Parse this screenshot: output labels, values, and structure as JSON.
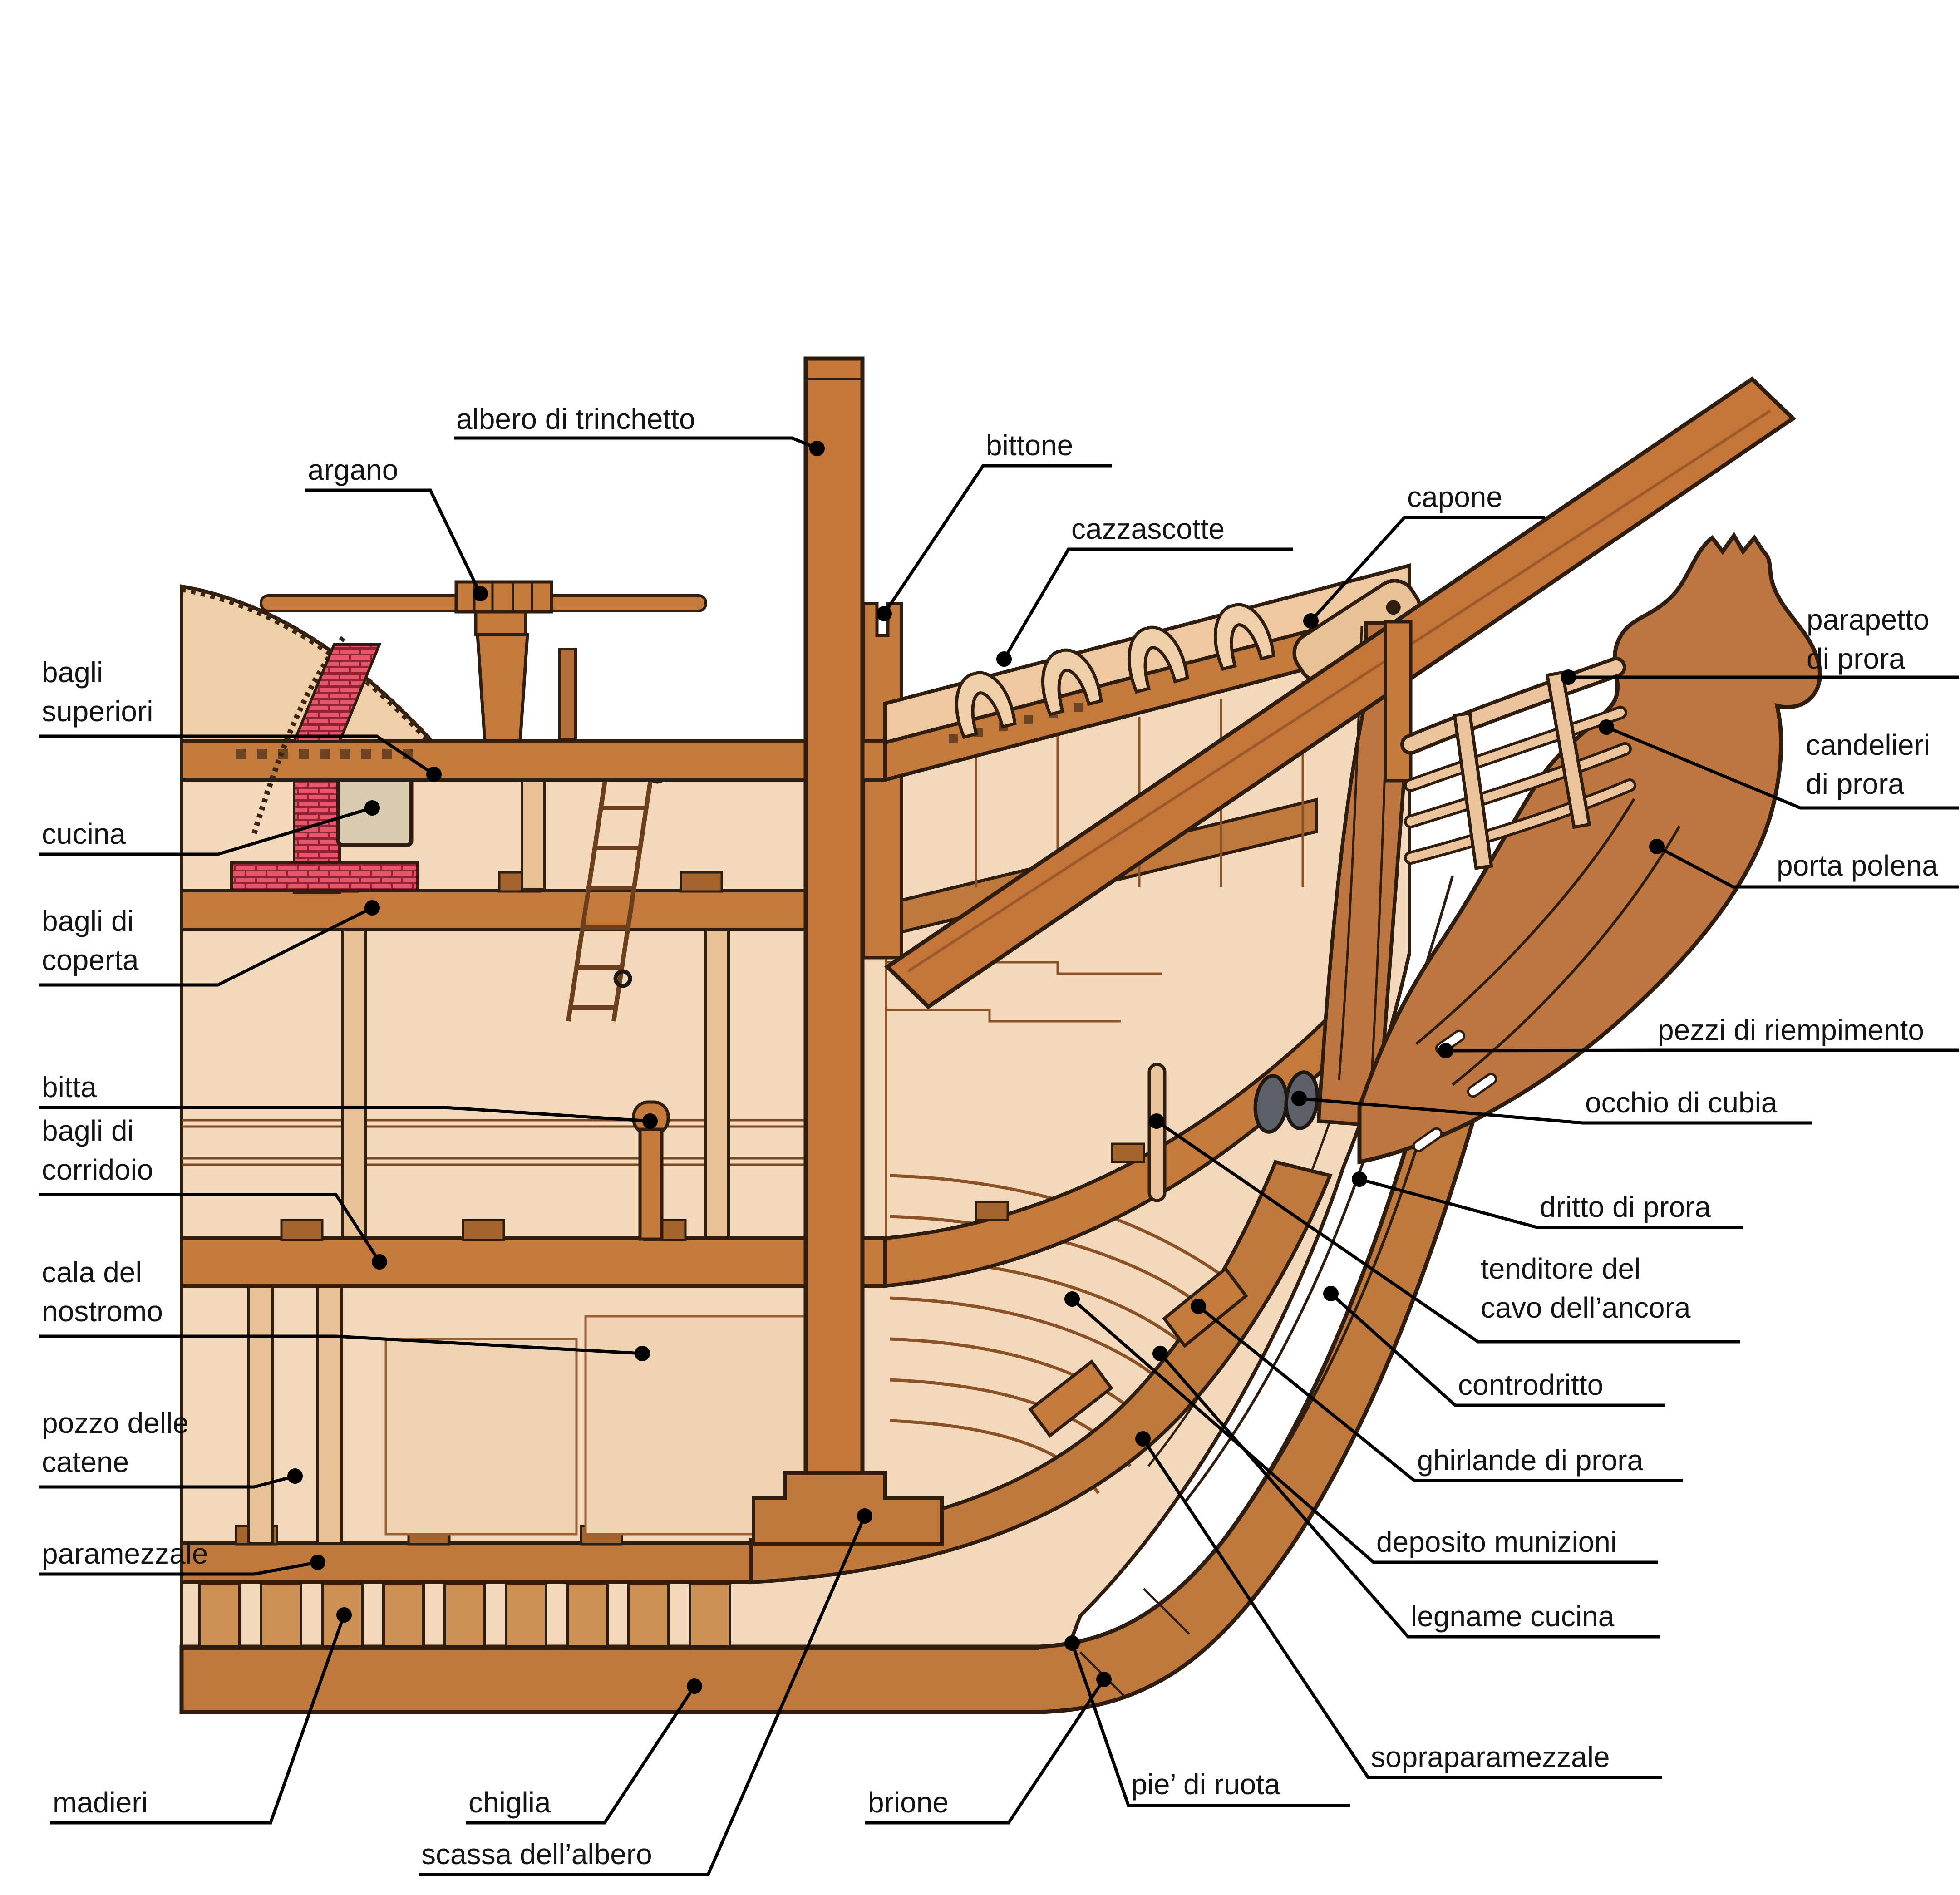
{
  "figure": {
    "kind": "ship bow cross-section diagram (Italian nautical terminology)",
    "background": "#ffffff"
  },
  "colors": {
    "wood_light_tan": "#f3d8bc",
    "wood_plank_tan": "#f0cfa8",
    "wood_mid_brown": "#c4793d",
    "wood_deep_brown": "#bd7640",
    "outline_dark": "#2f1d10",
    "brick_red": "#e8556b",
    "stove_grey": "#d8cdb2",
    "hawse_hole_grey": "#5d6069",
    "label_text": "#151515",
    "leader_line": "#000000"
  },
  "labels": [
    {
      "name": "albero-di-trinchetto",
      "lines": [
        "albero di trinchetto"
      ]
    },
    {
      "name": "argano",
      "lines": [
        "argano"
      ]
    },
    {
      "name": "bittone",
      "lines": [
        "bittone"
      ]
    },
    {
      "name": "cazzascotte",
      "lines": [
        "cazzascotte"
      ]
    },
    {
      "name": "capone",
      "lines": [
        "capone"
      ]
    },
    {
      "name": "bagli-superiori",
      "lines": [
        "bagli",
        "superiori"
      ]
    },
    {
      "name": "cucina",
      "lines": [
        "cucina"
      ]
    },
    {
      "name": "bagli-di-coperta",
      "lines": [
        "bagli di",
        "coperta"
      ]
    },
    {
      "name": "bitta",
      "lines": [
        "bitta"
      ]
    },
    {
      "name": "bagli-di-corridoio",
      "lines": [
        "bagli di",
        "corridoio"
      ]
    },
    {
      "name": "cala-del-nostromo",
      "lines": [
        "cala del",
        "nostromo"
      ]
    },
    {
      "name": "pozzo-delle-catene",
      "lines": [
        "pozzo delle",
        "catene"
      ]
    },
    {
      "name": "paramezzale",
      "lines": [
        "paramezzale"
      ]
    },
    {
      "name": "madieri",
      "lines": [
        "madieri"
      ]
    },
    {
      "name": "chiglia",
      "lines": [
        "chiglia"
      ]
    },
    {
      "name": "scassa-dell-albero",
      "lines": [
        "scassa dell’albero"
      ]
    },
    {
      "name": "brione",
      "lines": [
        "brione"
      ]
    },
    {
      "name": "pie-di-ruota",
      "lines": [
        "pie’ di ruota"
      ]
    },
    {
      "name": "sopraparamezzale",
      "lines": [
        "sopraparamezzale"
      ]
    },
    {
      "name": "legname-cucina",
      "lines": [
        "legname cucina"
      ]
    },
    {
      "name": "deposito-munizioni",
      "lines": [
        "deposito munizioni"
      ]
    },
    {
      "name": "ghirlande-di-prora",
      "lines": [
        "ghirlande di prora"
      ]
    },
    {
      "name": "controdritto",
      "lines": [
        "controdritto"
      ]
    },
    {
      "name": "tenditore-del-cavo-dell-ancora",
      "lines": [
        "tenditore del",
        "cavo dell’ancora"
      ]
    },
    {
      "name": "dritto-di-prora",
      "lines": [
        "dritto di prora"
      ]
    },
    {
      "name": "occhio-di-cubia",
      "lines": [
        "occhio di cubia"
      ]
    },
    {
      "name": "pezzi-di-riempimento",
      "lines": [
        "pezzi di riempimento"
      ]
    },
    {
      "name": "porta-polena",
      "lines": [
        "porta polena"
      ]
    },
    {
      "name": "candelieri-di-prora",
      "lines": [
        "candelieri",
        "di prora"
      ]
    },
    {
      "name": "parapetto-di-prora",
      "lines": [
        "parapetto",
        "di prora"
      ]
    }
  ]
}
